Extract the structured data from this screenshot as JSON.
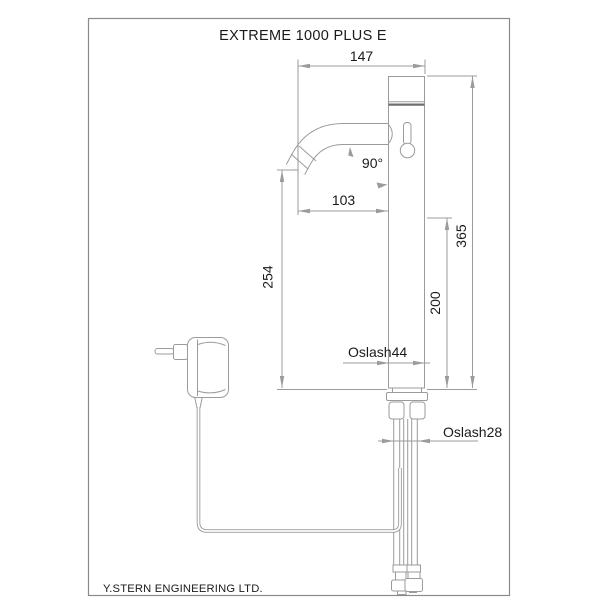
{
  "title": "EXTREME 1000 PLUS E",
  "footer": "Y.STERN ENGINEERING LTD.",
  "dimensions": {
    "top_width": "147",
    "spout_angle": "90°",
    "spout_reach": "103",
    "spout_height": "254",
    "sensor_height": "200",
    "total_height": "365",
    "body_diameter": "Oslash44",
    "shank_diameter": "Oslash28"
  },
  "colors": {
    "background": "#ffffff",
    "line": "#9b9b9b",
    "dark_line": "#6f6f6f",
    "frame": "#8a8a8a",
    "text": "#1a1a1a"
  }
}
